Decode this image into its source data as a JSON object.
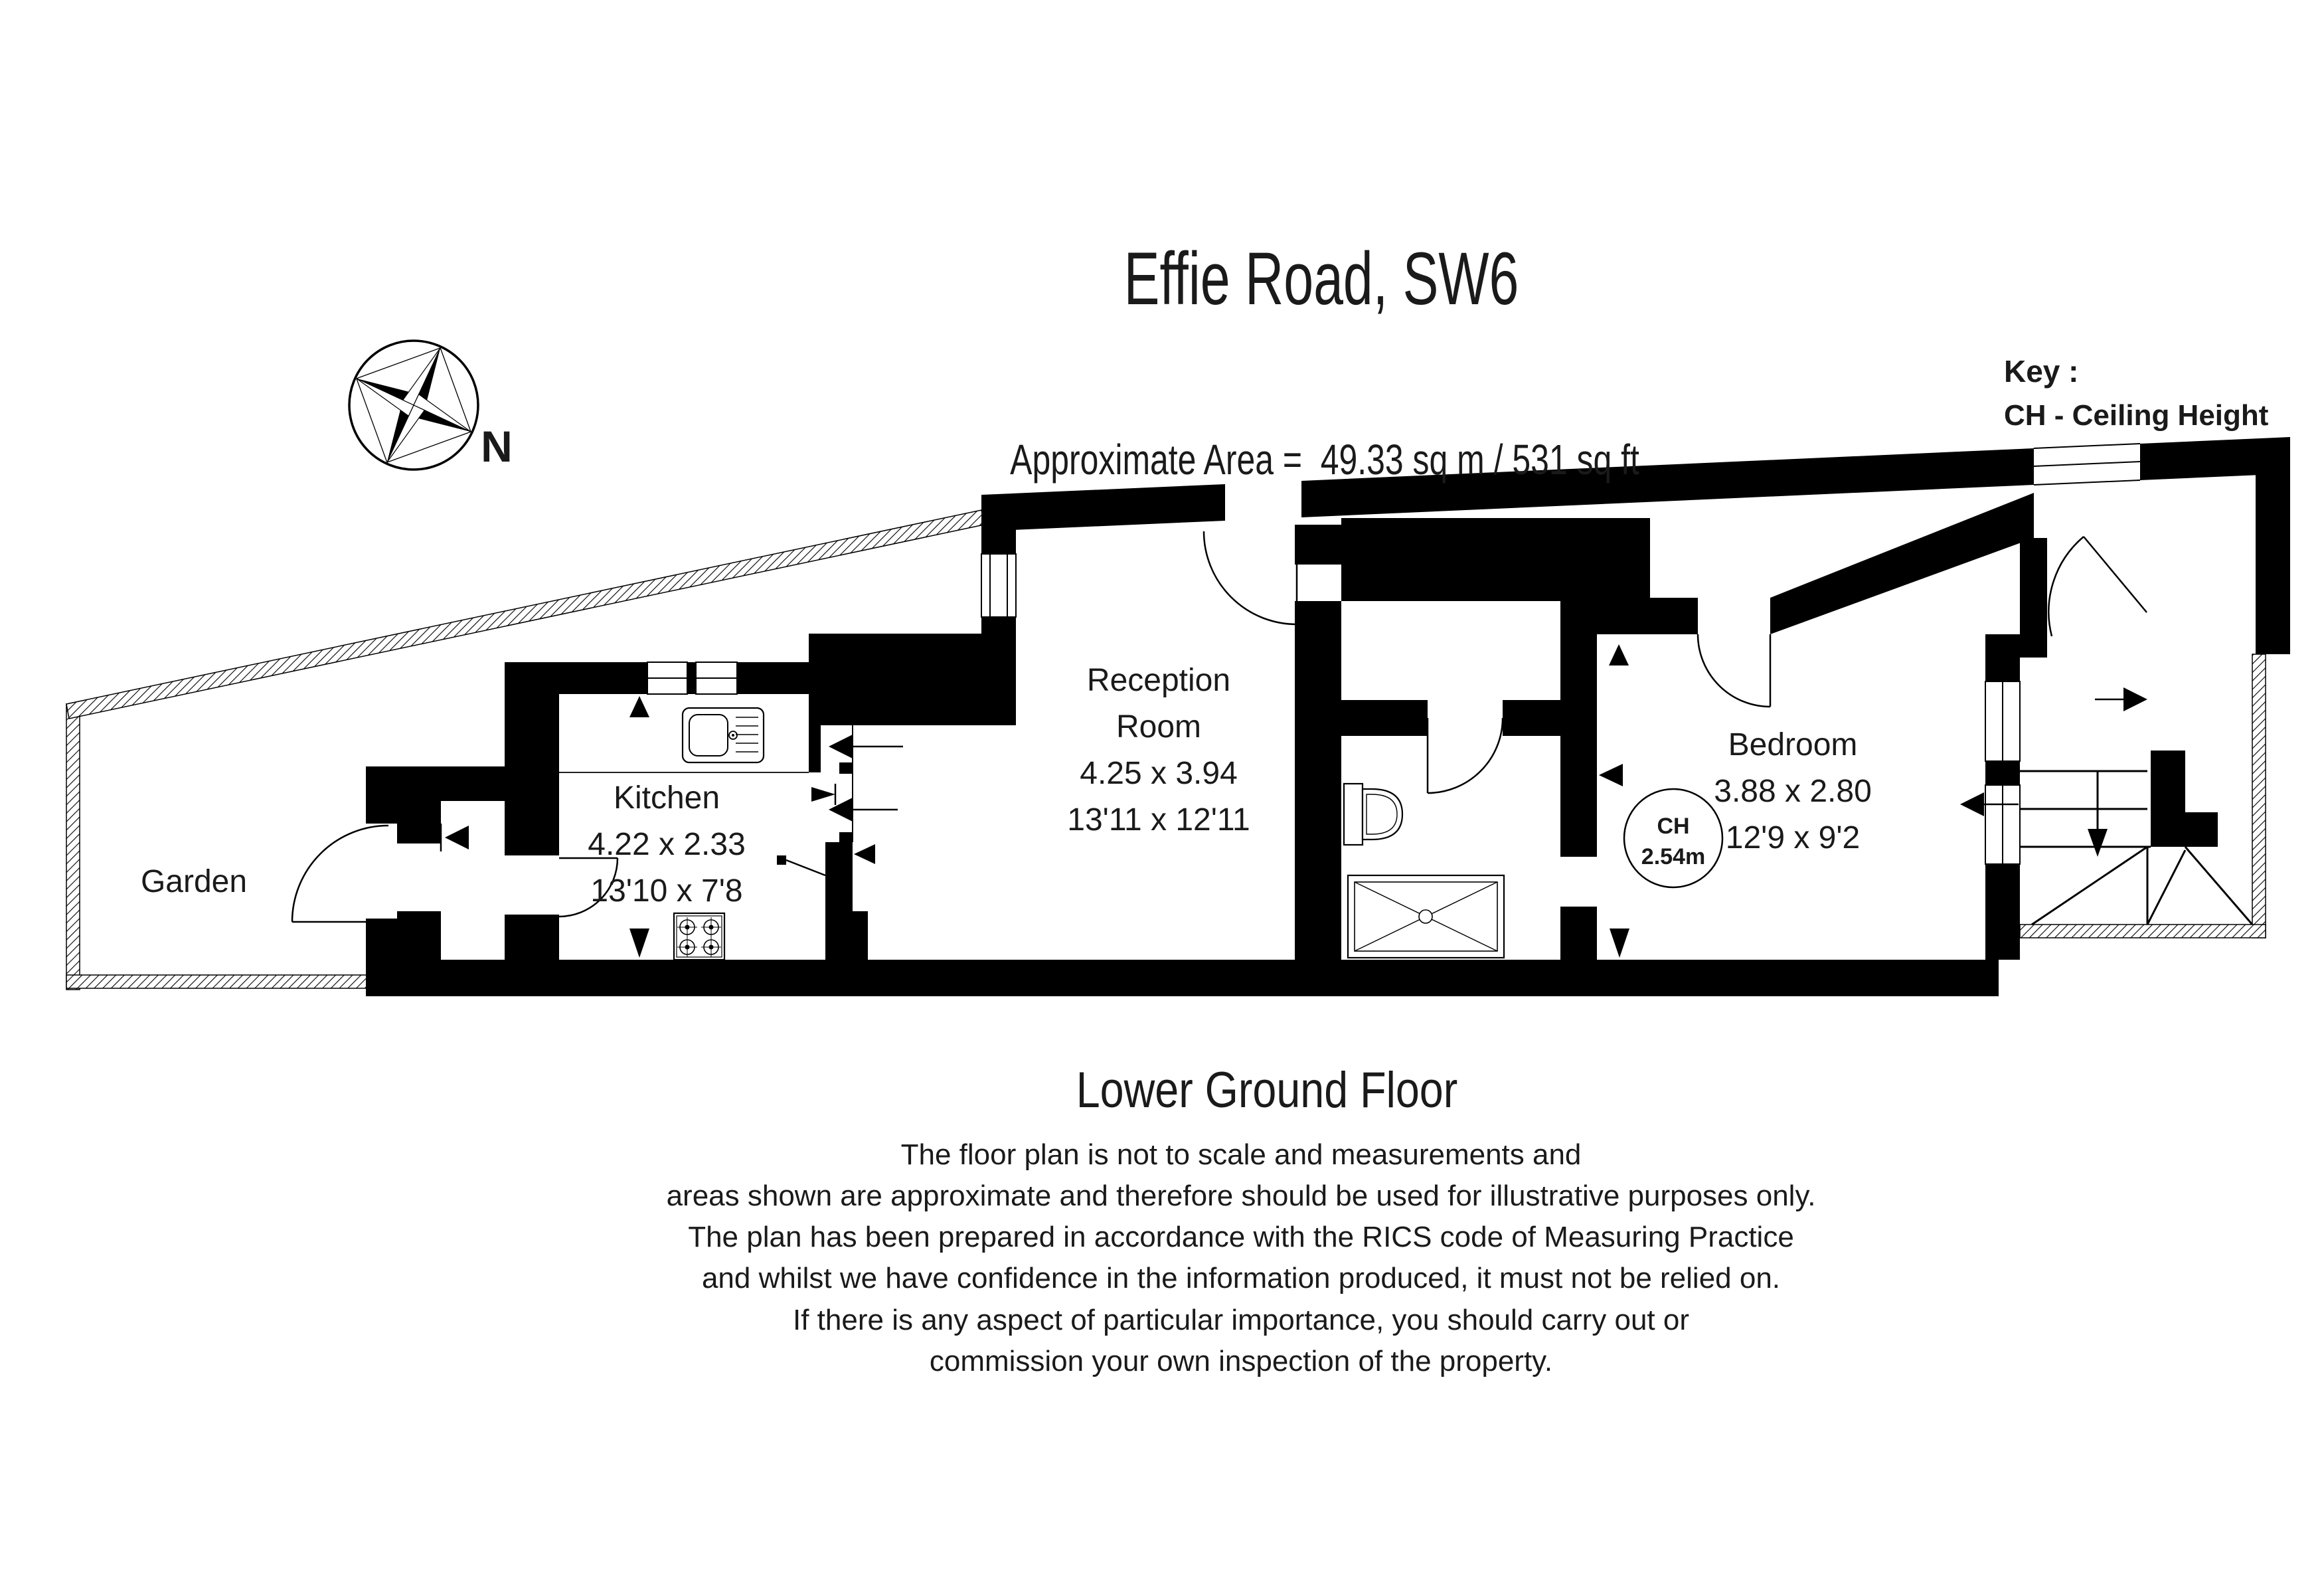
{
  "header": {
    "title": "Effie Road, SW6",
    "subtitle": "Approximate Area =  49.33 sq m / 531 sq ft"
  },
  "key": {
    "heading": "Key :",
    "entry": "CH - Ceiling Height"
  },
  "compass": {
    "north_label": "N"
  },
  "rooms": {
    "garden": {
      "name": "Garden"
    },
    "kitchen": {
      "name": "Kitchen",
      "metric": "4.22 x 2.33",
      "imperial": "13'10 x 7'8"
    },
    "reception": {
      "name_line1": "Reception",
      "name_line2": "Room",
      "metric": "4.25 x 3.94",
      "imperial": "13'11 x 12'11"
    },
    "bedroom": {
      "name": "Bedroom",
      "metric": "3.88 x 2.80",
      "imperial": "12'9 x 9'2",
      "ceiling_height_label": "CH",
      "ceiling_height_value": "2.54m"
    }
  },
  "floor_label": "Lower Ground Floor",
  "disclaimer": [
    "The floor plan is not to scale and measurements and",
    "areas shown are approximate and therefore should be used for illustrative purposes only.",
    "The plan has been prepared in accordance with the RICS code of Measuring Practice",
    "and whilst we have confidence in the information produced, it must not be relied on.",
    "If there is any aspect of particular importance, you should carry out or",
    "commission your own inspection of the property."
  ],
  "colors": {
    "wall": "#000000",
    "background": "#ffffff",
    "text": "#1a1a1a"
  }
}
